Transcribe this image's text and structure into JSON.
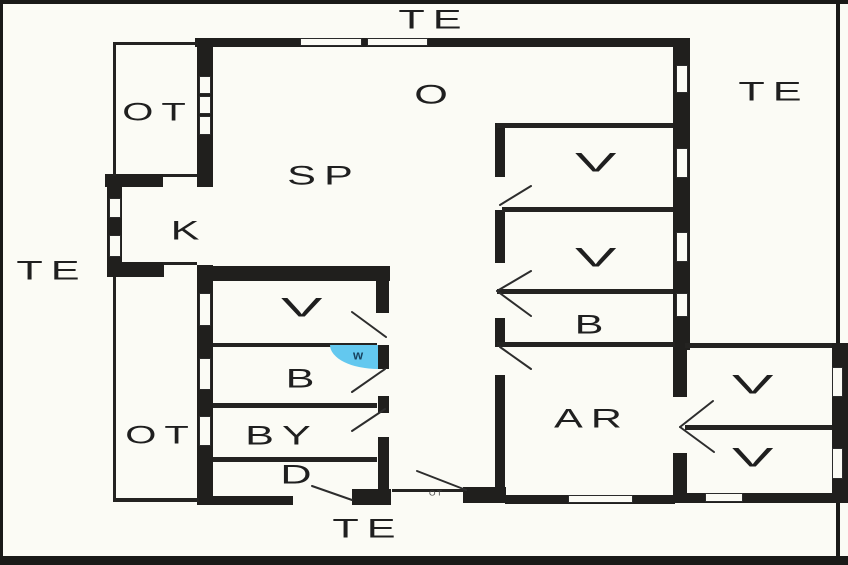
{
  "colors": {
    "background": "#fbfbf5",
    "wall": "#201f1d",
    "water_blue": "#63c8ef",
    "text": "#1f1f1f"
  },
  "terrace_labels": [
    {
      "id": "te-top",
      "text": "TE"
    },
    {
      "id": "te-right",
      "text": "TE"
    },
    {
      "id": "te-left",
      "text": "TE"
    },
    {
      "id": "te-bottom",
      "text": "TE"
    }
  ],
  "room_labels": [
    {
      "id": "ot-upper",
      "text": "OT"
    },
    {
      "id": "ot-lower",
      "text": "OT"
    },
    {
      "id": "o",
      "text": "O"
    },
    {
      "id": "sp",
      "text": "SP"
    },
    {
      "id": "k",
      "text": "K"
    },
    {
      "id": "v-right-1",
      "text": "V"
    },
    {
      "id": "v-right-2",
      "text": "V"
    },
    {
      "id": "b-right",
      "text": "B"
    },
    {
      "id": "v-left",
      "text": "V"
    },
    {
      "id": "b-left",
      "text": "B"
    },
    {
      "id": "by",
      "text": "BY"
    },
    {
      "id": "d",
      "text": "D"
    },
    {
      "id": "ar",
      "text": "AR"
    },
    {
      "id": "v-annex-1",
      "text": "V"
    },
    {
      "id": "v-annex-2",
      "text": "V"
    }
  ],
  "fixture_labels": [
    {
      "id": "w-marker",
      "text": "w"
    },
    {
      "id": "ot-entrance",
      "text": "OT"
    }
  ]
}
